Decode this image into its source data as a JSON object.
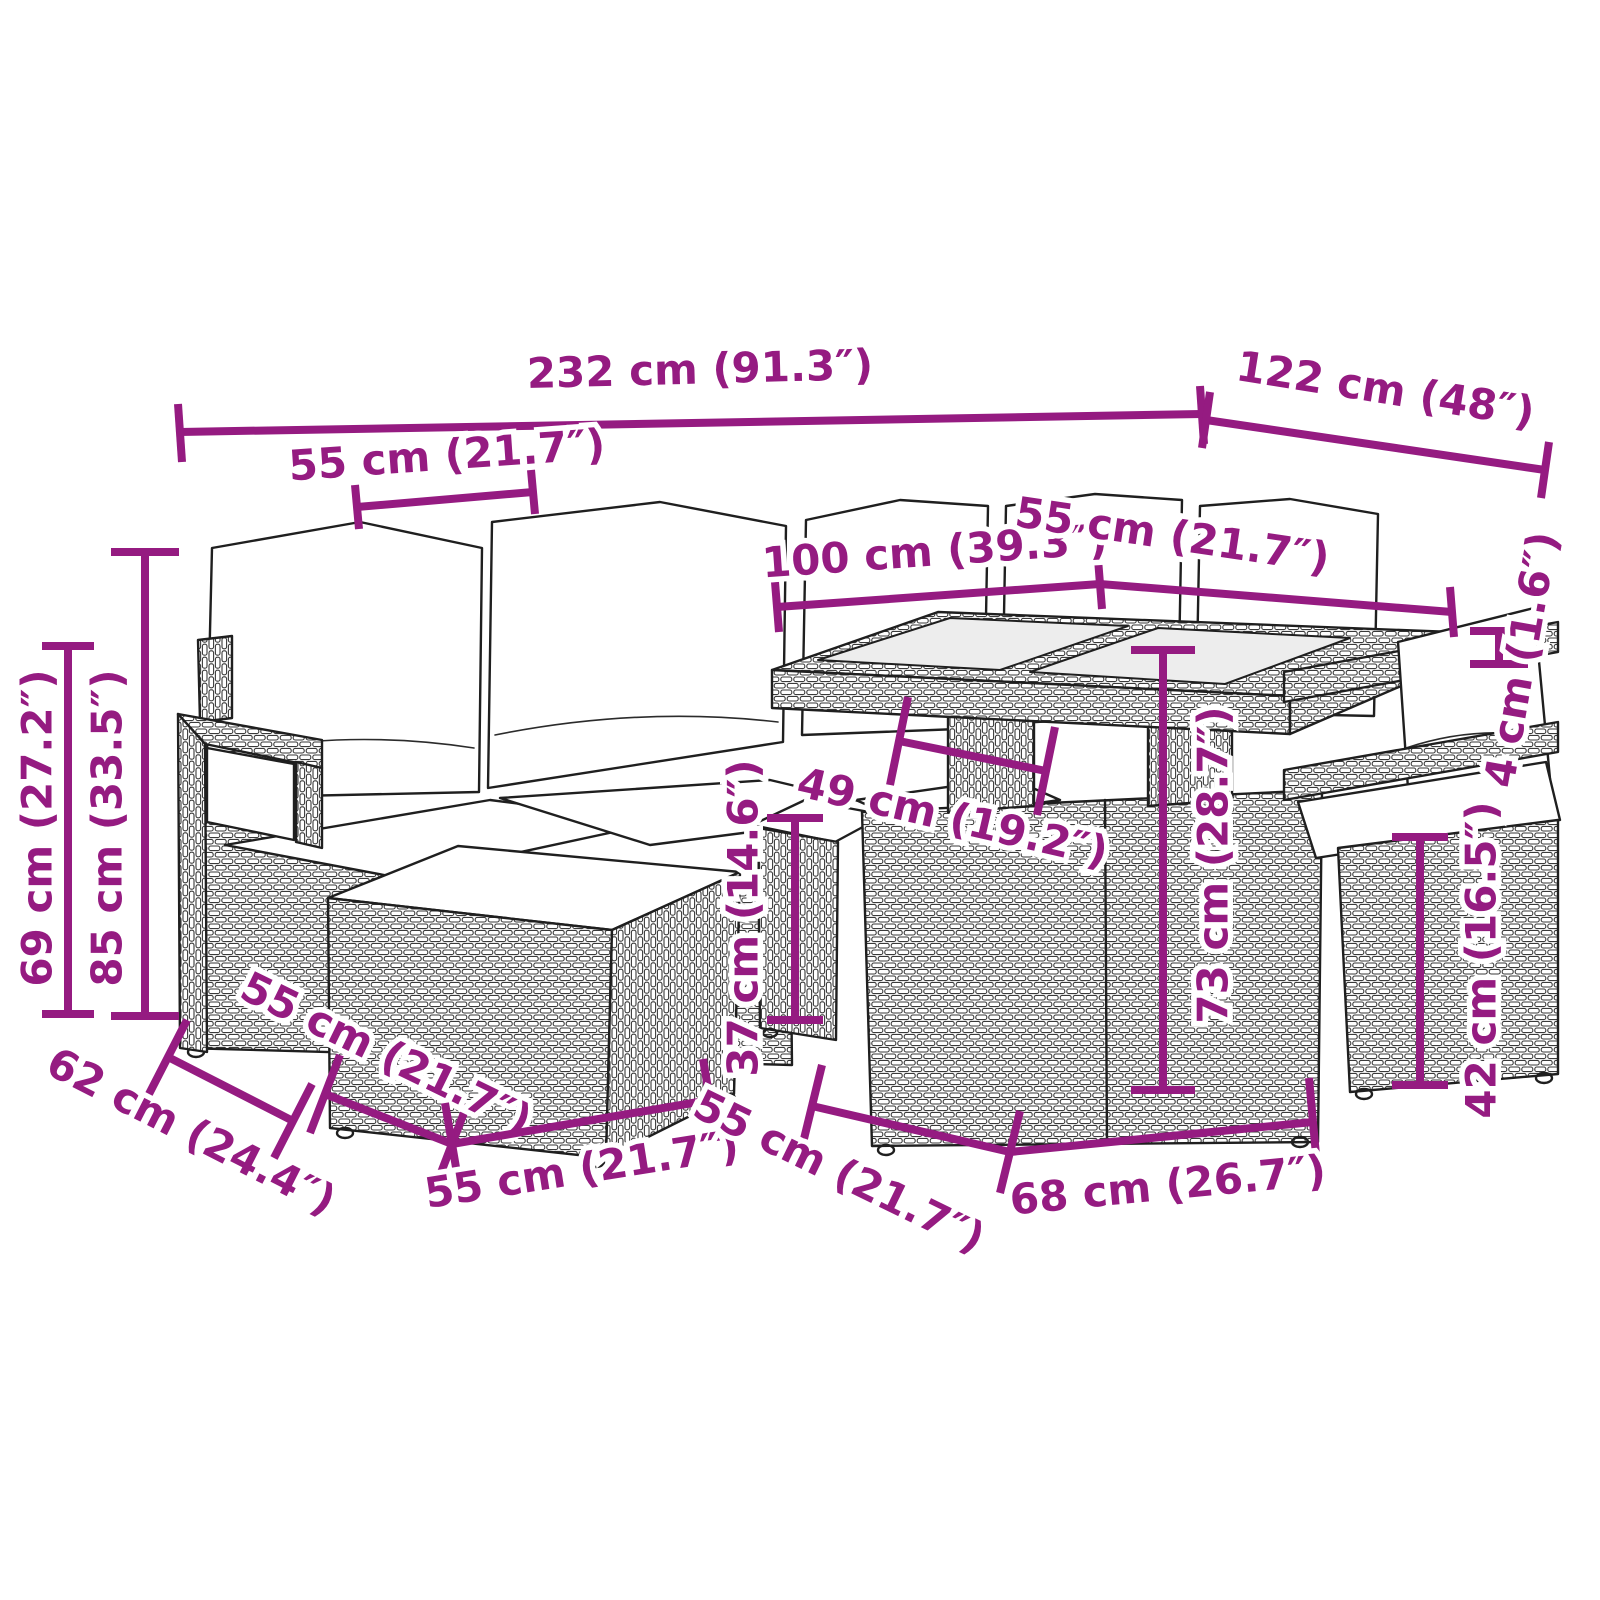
{
  "figure": {
    "kind": "product dimension diagram",
    "depicts": "7-piece poly rattan garden lounge set: corner sofa with back cushions, footstool ottomans, cube stools and a glass-top cube table",
    "background": "#ffffff",
    "line_color": "#1f1f1f",
    "dimension_color": "#951b81",
    "cushion_color": "#ffffff",
    "glass_color": "#ededed"
  },
  "dimensions": {
    "overall_width": {
      "label": "232 cm (91.3″)",
      "cm": 232,
      "inches": 91.3,
      "orientation": "horizontal-top"
    },
    "overall_depth": {
      "label": "122 cm (48″)",
      "cm": 122,
      "inches": 48,
      "orientation": "diagonal-top-right"
    },
    "seat_width": {
      "label": "55 cm (21.7″)",
      "cm": 55,
      "inches": 21.7,
      "orientation": "horizontal-seat-top"
    },
    "table_length": {
      "label": "100 cm (39.3″)",
      "cm": 100,
      "inches": 39.3,
      "orientation": "horizontal-table-top"
    },
    "table_depth": {
      "label": "55 cm (21.7″)",
      "cm": 55,
      "inches": 21.7,
      "orientation": "diagonal-table-top-right"
    },
    "glass_thickness": {
      "label": "4 cm (1.6″)",
      "cm": 4,
      "inches": 1.6,
      "orientation": "vertical-right"
    },
    "back_height": {
      "label": "85 cm (33.5″)",
      "cm": 85,
      "inches": 33.5,
      "orientation": "vertical-left"
    },
    "armrest_height": {
      "label": "69 cm (27.2″)",
      "cm": 69,
      "inches": 27.2,
      "orientation": "vertical-left"
    },
    "ottoman_height": {
      "label": "37 cm (14.6″)",
      "cm": 37,
      "inches": 14.6,
      "orientation": "vertical-center"
    },
    "table_height": {
      "label": "73 cm (28.7″)",
      "cm": 73,
      "inches": 28.7,
      "orientation": "vertical-center-right"
    },
    "stool_height": {
      "label": "42 cm (16.5″)",
      "cm": 42,
      "inches": 16.5,
      "orientation": "vertical-right"
    },
    "shelf_depth": {
      "label": "49 cm (19.2″)",
      "cm": 49,
      "inches": 19.2,
      "orientation": "diagonal-table-shelf"
    },
    "seat_depth": {
      "label": "62 cm (24.4″)",
      "cm": 62,
      "inches": 24.4,
      "orientation": "diagonal-bottom-left"
    },
    "ottoman_depth": {
      "label": "55 cm (21.7″)",
      "cm": 55,
      "inches": 21.7,
      "orientation": "diagonal-bottom-left"
    },
    "ottoman_width": {
      "label": "55 cm (21.7″)",
      "cm": 55,
      "inches": 21.7,
      "orientation": "horizontal-bottom-center"
    },
    "stool_depth": {
      "label": "55 cm (21.7″)",
      "cm": 55,
      "inches": 21.7,
      "orientation": "diagonal-bottom-right"
    },
    "stool_width": {
      "label": "68 cm (26.7″)",
      "cm": 68,
      "inches": 26.7,
      "orientation": "horizontal-bottom-right"
    }
  }
}
